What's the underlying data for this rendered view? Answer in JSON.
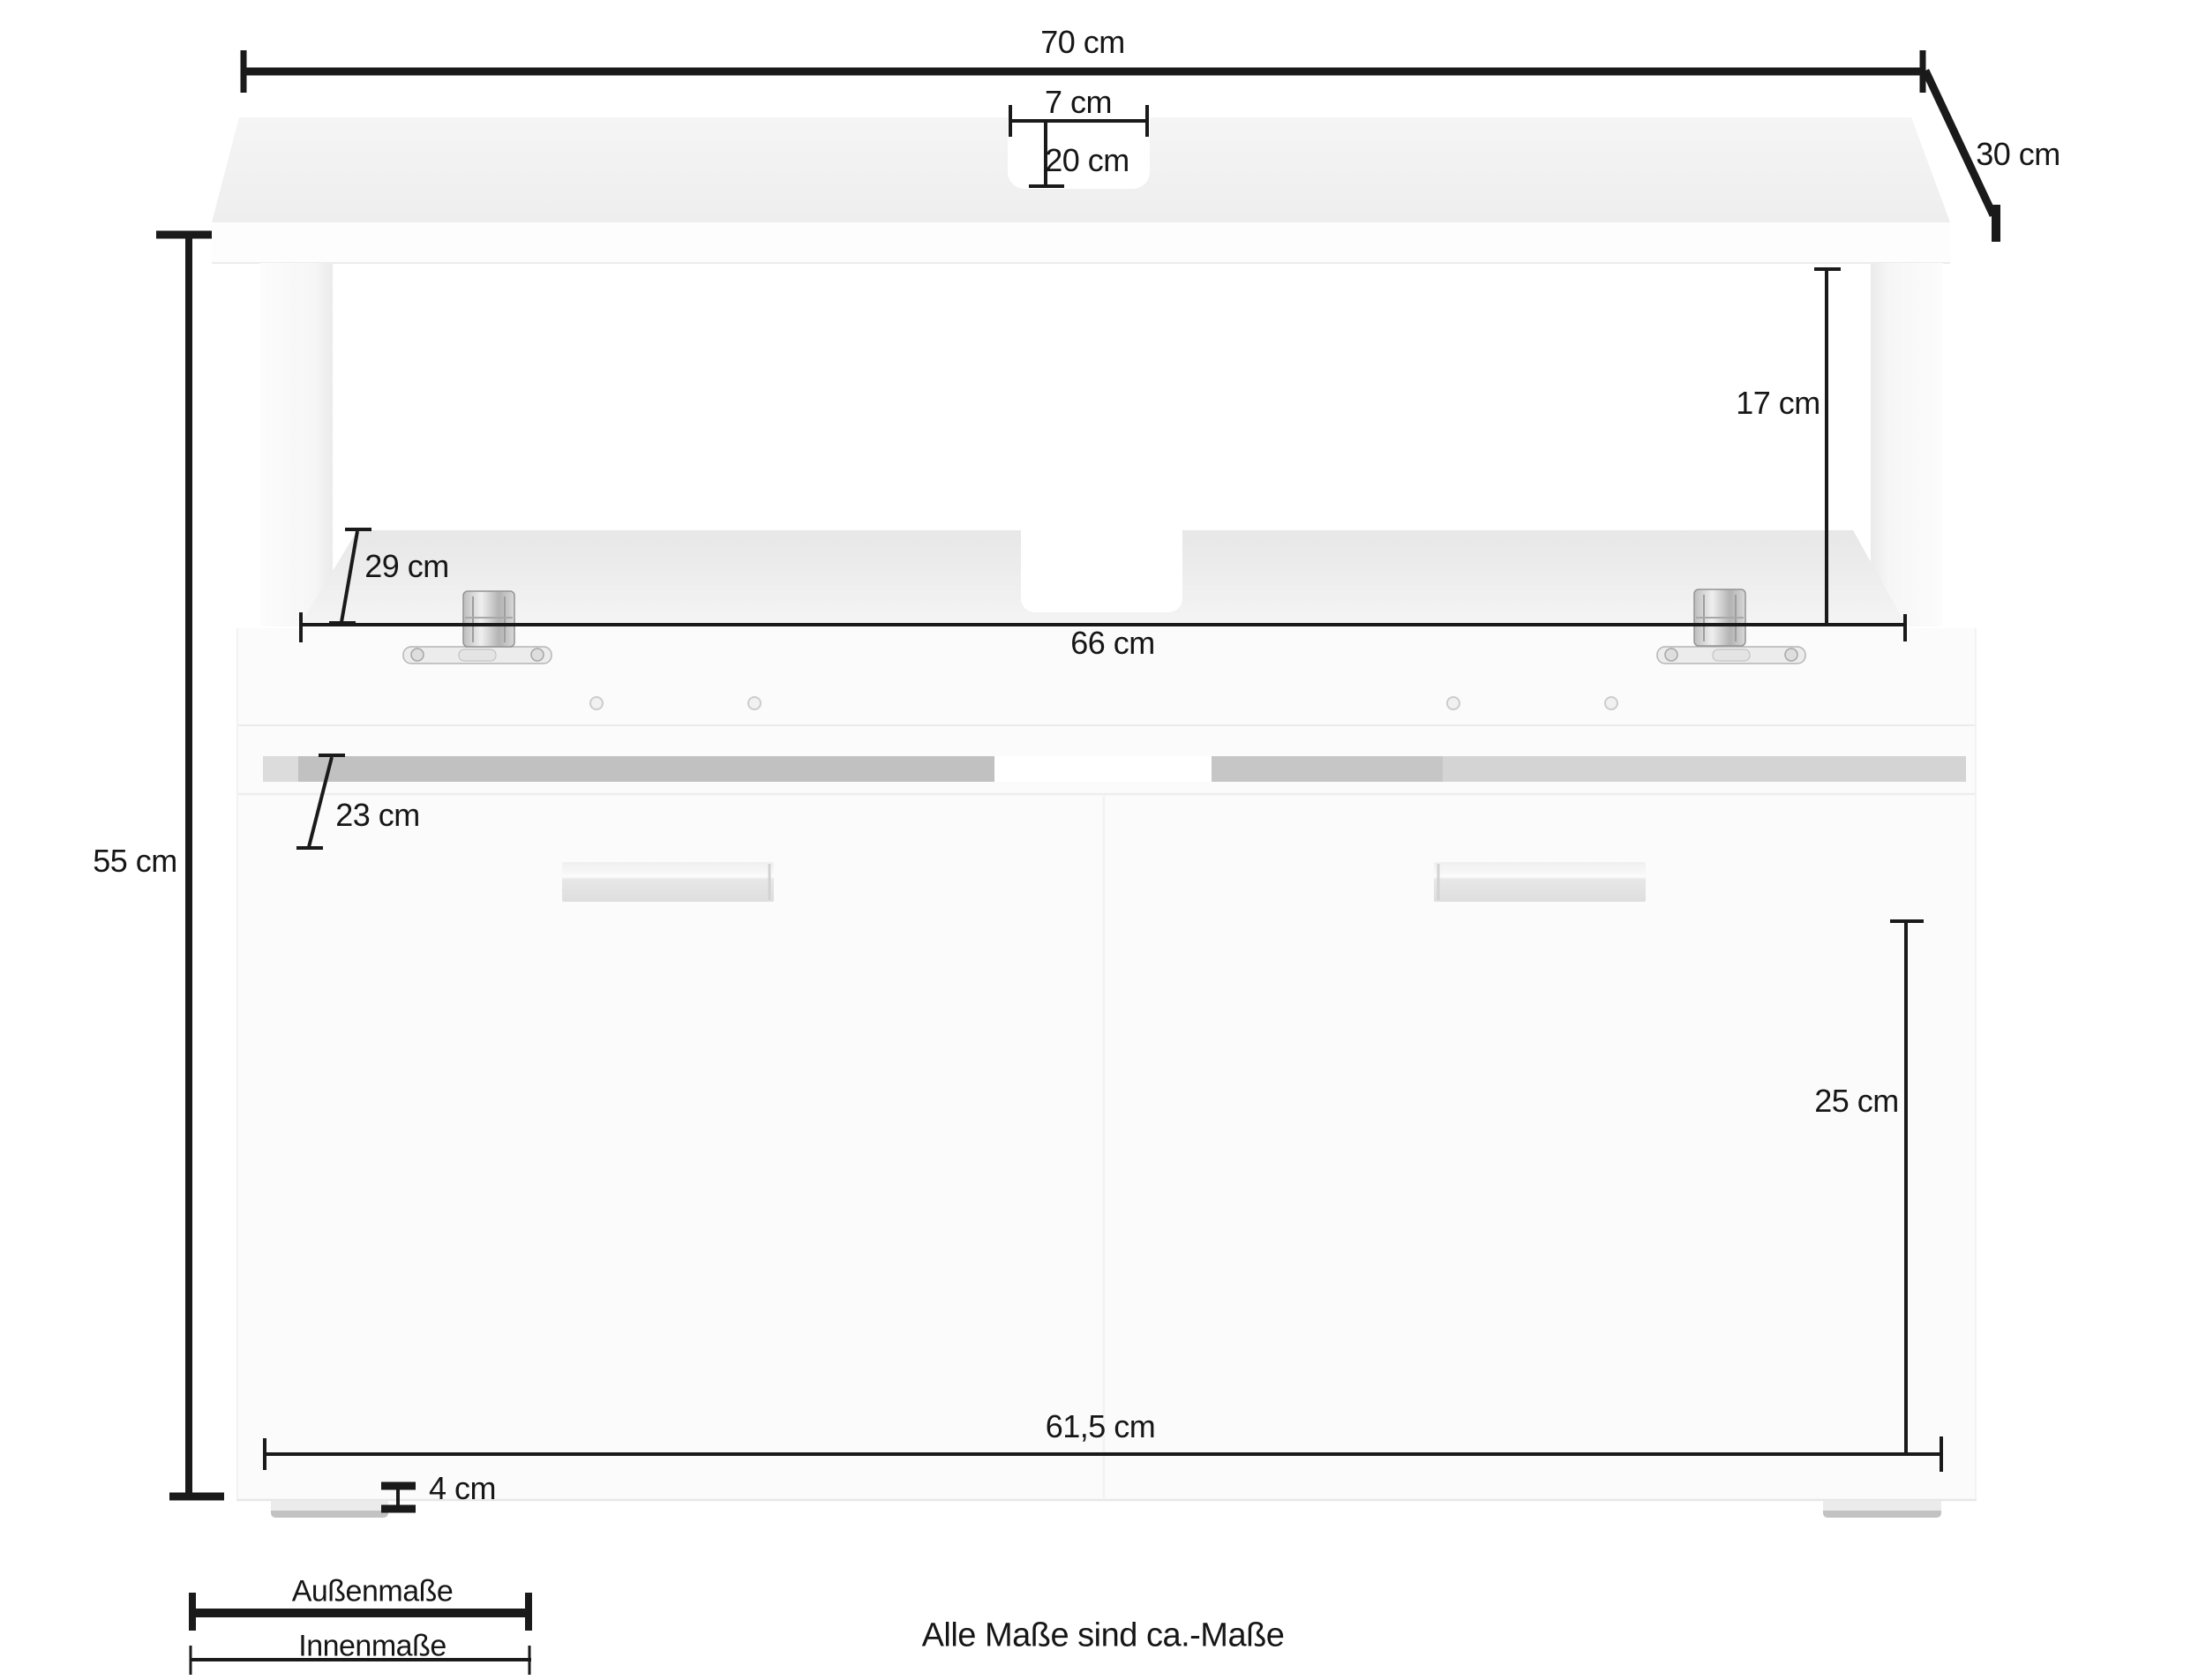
{
  "diagram": {
    "note": "Alle Maße sind ca.-Maße",
    "legend": {
      "outer_label": "Außenmaße",
      "inner_label": "Innenmaße"
    },
    "dimensions": {
      "outer_width": "70 cm",
      "outer_depth": "30 cm",
      "outer_height": "55 cm",
      "top_cutout_width": "7 cm",
      "top_cutout_depth": "20 cm",
      "shelf_inner_height": "17 cm",
      "shelf_inner_width": "66 cm",
      "shelf_inner_depth": "29 cm",
      "cabinet_inner_depth": "23 cm",
      "cabinet_inner_height": "25 cm",
      "cabinet_inner_width": "61,5 cm",
      "foot_height": "4 cm"
    },
    "colors": {
      "dimension_line": "#1a1a1a",
      "furniture_surface": "#f2f2f2",
      "shadow_band": "#c1c1c1",
      "hinge_metal": "#c7c7c7"
    }
  }
}
